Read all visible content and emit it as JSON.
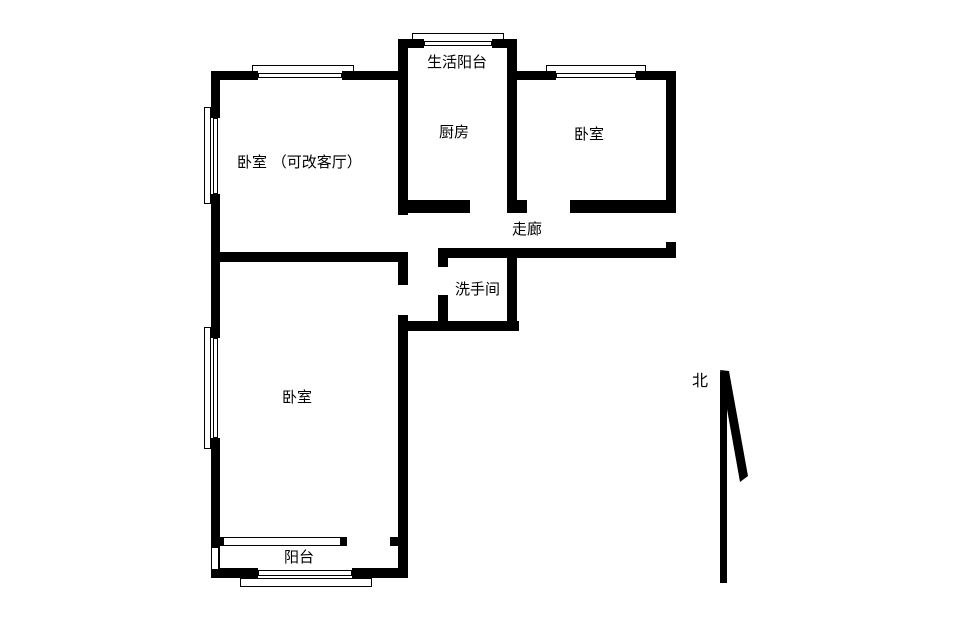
{
  "colors": {
    "wall": "#000000",
    "background": "#ffffff",
    "text": "#000000"
  },
  "rooms": {
    "service_balcony": {
      "label": "生活阳台"
    },
    "kitchen": {
      "label": "厨房"
    },
    "bedroom_top_right": {
      "label": "卧室"
    },
    "bedroom_top_left": {
      "label": "卧室 （可改客厅）"
    },
    "corridor": {
      "label": "走廊"
    },
    "bathroom": {
      "label": "洗手间"
    },
    "bedroom_bottom": {
      "label": "卧室"
    },
    "balcony": {
      "label": "阳台"
    }
  },
  "compass": {
    "north_label": "北"
  }
}
